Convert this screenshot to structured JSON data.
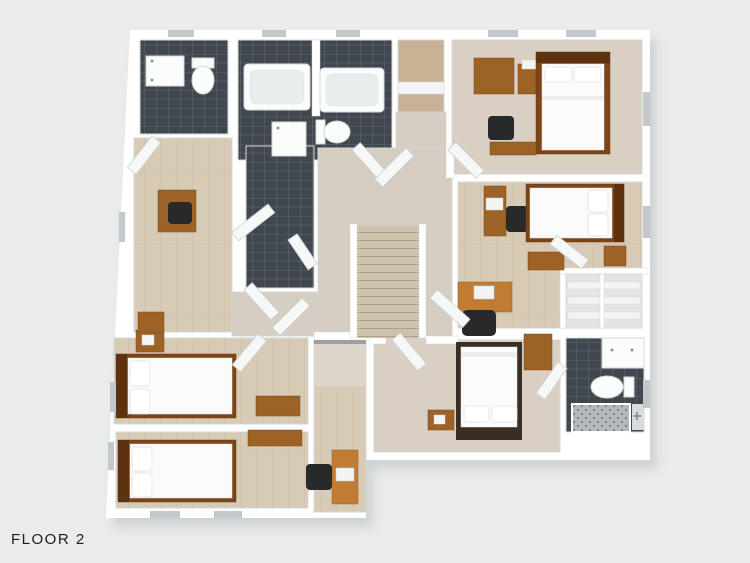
{
  "floor_label": "FLOOR 2",
  "colors": {
    "background": "#e9ebec",
    "plan_shadow": "#b9bdc0",
    "wall": "#ffffff",
    "wall_edge": "#d5d8da",
    "wood_floor": "#d8cbb6",
    "hall_floor": "#d5cdc1",
    "carpet_floor": "#d9d0c3",
    "closet_wood": "#c8b295",
    "closet_floor": "#e3e4e5",
    "dark_tile": "#40474f",
    "tile_grout": "#5d656d",
    "shower_floor": "#b4b8ba",
    "fixture_white": "#fbfcfc",
    "tub_inner": "#e9edee",
    "bed_frame": "#7c4517",
    "bed_frame_dark": "#3a2e22",
    "bed_headboard": "#5e3210",
    "mattress": "#fbfbfb",
    "pillow": "#ffffff",
    "wood_dark": "#8a5220",
    "wood_medium": "#9d6226",
    "desk_orange": "#c07b35",
    "chair_dark": "#27292b",
    "stair_wood": "#cfc2ac",
    "stair_edge": "#9a8d77",
    "window_slot": "#c3c8cb",
    "door_white": "#f6f7f7",
    "door_edge": "#cdd1d3",
    "text_color": "#1b1b1b"
  }
}
